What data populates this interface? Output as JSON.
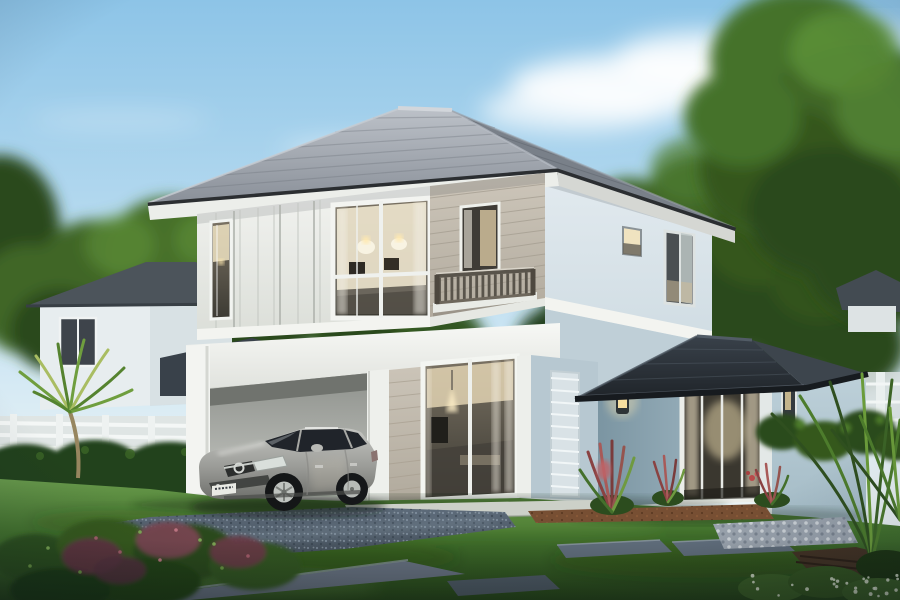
{
  "meta": {
    "domain": "Natural-Image",
    "title": "Two-storey house exterior - dusk architectural render",
    "canvas": {
      "width": 900,
      "height": 600
    }
  },
  "scene": {
    "title": "Modern two-storey detached house with open carport, garden pavilion and a silver hatchback parked under it, at dusk",
    "objects": {
      "sky": {
        "label": "Dusk sky with soft white clouds"
      },
      "background_trees": {
        "label": "Backdrop of garden trees"
      },
      "neighbor_house": {
        "label": "Neighbouring white house with grey hip roof"
      },
      "distant_house": {
        "label": "Distant roof behind the right fence"
      },
      "fence": {
        "label": "White garden fence"
      },
      "hedge": {
        "label": "Clipped green hedge"
      },
      "main_house": {
        "label": "Two-storey house with grey tiled hip roof"
      },
      "upper_floor": {
        "label": "Upper floor with white board panelling and warm lit windows"
      },
      "balcony": {
        "label": "Balcony with dark timber railing"
      },
      "carport": {
        "label": "Open carport under the upper floor"
      },
      "living_window": {
        "label": "Ground-floor living-room picture window, warm lit interior"
      },
      "pavilion": {
        "label": "Single-storey garden pavilion with dark hip roof and glass sliding doors"
      },
      "wall_lamp": {
        "label": "Glowing wall lantern"
      },
      "car": {
        "label": "Silver hatchback parked in the carport"
      },
      "license_plate": {
        "label": "White licence plate (characters illegible)"
      },
      "lawn": {
        "label": "Manicured lawn"
      },
      "driveway": {
        "label": "Blue-grey gravel driveway"
      },
      "stepping_stones": {
        "label": "Grey stepping-stone path with pebble bed"
      },
      "planting": {
        "label": "Palms, white plumeria, red cordylines and shrubs"
      }
    }
  },
  "colors": {
    "sky_top": "#8dc4e7",
    "sky_mid": "#c3e1f2",
    "sky_horizon": "#eaf3f6",
    "cloud": "#ffffff",
    "tree_dark": "#2c4a1d",
    "tree_mid": "#3f6628",
    "tree_light": "#5b8c36",
    "roof_light": "#bcc1c8",
    "roof_mid": "#8a9099",
    "roof_side": "#798089",
    "roof_fascia": "#2b2e31",
    "roof_soffit": "#eceeea",
    "wall_panel": "#eff1ee",
    "wall_siding": "#c7c0b3",
    "wall_blue_pale": "#dde7ec",
    "wall_blue": "#b7c8d1",
    "pavilion_wall": "#8aa2af",
    "pavilion_wall_light": "#b6cad4",
    "pavilion_roof": "#2c3238",
    "pavilion_roof_side": "#3d454d",
    "slab_white": "#f3f4f0",
    "window_frame": "#f3f5f1",
    "glass_dark": "#3c3a34",
    "glass_warm": "#f0e3c0",
    "lamp_glow": "#ffe9b0",
    "balcony_rail": "#59544b",
    "neighbor_wall": "#e7edef",
    "neighbor_roof": "#4c545b",
    "fence_white": "#e9efee",
    "hedge": "#24421a",
    "lawn_light": "#689a4b",
    "lawn_mid": "#41702b",
    "lawn_dark": "#27461c",
    "gravel_light": "#5e6c7b",
    "gravel_dark": "#3f4a55",
    "stone": "#5f6c7a",
    "path_grey": "#667080",
    "pebble_bed": "#98a1ab",
    "mulch": "#774f33",
    "deck_wood": "#443324",
    "car_light": "#c6c7c3",
    "car_mid": "#9b9c98",
    "car_dark": "#6f706c",
    "car_glass": "#20242a",
    "plate": "#e9eae4",
    "plant_red": "#8a4242",
    "flower_white": "#f3f4ee"
  }
}
